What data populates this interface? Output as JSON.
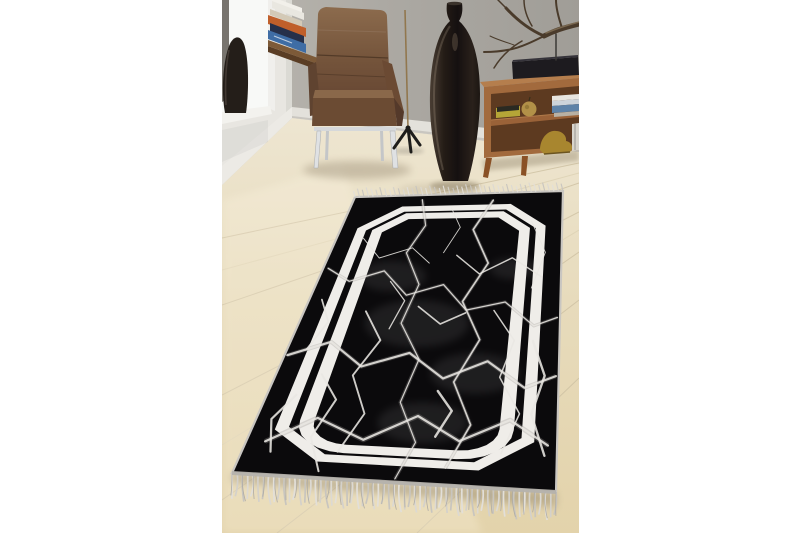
{
  "image": {
    "type": "product-photo",
    "subject": "Black and white marble-patterned fringed area rug styled in a living room with leather armchair, floor vase, branch decor and wooden sideboard",
    "background": "#ffffff"
  },
  "scene": {
    "objects": [
      {
        "id": "window",
        "label": "bright window opening with dark vase on the sill"
      },
      {
        "id": "book-stack",
        "label": "stack of books on a wall-mounted wooden shelf"
      },
      {
        "id": "armchair",
        "label": "brown leather armchair on chrome legs"
      },
      {
        "id": "floor-lamp",
        "label": "thin brass stand with black tripod base"
      },
      {
        "id": "floor-vase",
        "label": "tall dark bottle-shaped floor vase"
      },
      {
        "id": "branch",
        "label": "dry decorative branch on a stand"
      },
      {
        "id": "sideboard",
        "label": "mid-century wooden sideboard with ornaments and books"
      },
      {
        "id": "rug",
        "label": "black marble rug with double white frame border and fringe"
      }
    ]
  },
  "palette": {
    "wall_left": "#e8e6e1",
    "wall_back_near": "#a29f99",
    "wall_back_far": "#b8b5ae",
    "window": "#f8f9f7",
    "baseboard": "#eceae5",
    "floor": "#e6dab9",
    "leather": "#6e4e36",
    "wood_sideboard": "#a26a3d",
    "shelf_wood": "#7d5a38"
  },
  "rug": {
    "base_color": "#0b0a0c",
    "band_color": "#efede9",
    "vein_color": "#e9e7e3",
    "vein_ghost": "#9a9896",
    "binding_color": "#c9c6c1",
    "fringe_colors": [
      "#e2dfd9",
      "#d4d1cb",
      "#c8c5bf",
      "#dcd9d3"
    ],
    "design": "double white line frame with chamfered top corners and arched bottom corners over black marble crack field, fringed short ends",
    "frame": {
      "outer_band": {
        "a": 0.075,
        "b": 0.048,
        "c": 0.17,
        "cv": 0.09,
        "a2": 0.1175,
        "b2": 0.0707,
        "c2": 0.145,
        "cv2": 0.0773
      },
      "inner_band": {
        "a": 0.145,
        "b": 0.0773,
        "c": 0.129,
        "cv": 0.0687,
        "r": 0.175,
        "rv": 0.0933,
        "a2": 0.1925,
        "b2": 0.1027,
        "c2": 0.101,
        "cv2": 0.054,
        "r2": 0.1275,
        "rv2": 0.068
      }
    },
    "smudges": [
      [
        0.45,
        0.5,
        0.2
      ],
      [
        0.3,
        0.33,
        0.14
      ],
      [
        0.7,
        0.66,
        0.16
      ],
      [
        0.55,
        0.82,
        0.15
      ],
      [
        0.8,
        0.3,
        0.1
      ]
    ],
    "veins": [
      [
        [
          0.33,
          0.02
        ],
        [
          0.38,
          0.13
        ],
        [
          0.33,
          0.24
        ],
        [
          0.42,
          0.36
        ],
        [
          0.39,
          0.5
        ],
        [
          0.49,
          0.62
        ],
        [
          0.46,
          0.76
        ],
        [
          0.54,
          0.88
        ],
        [
          0.5,
          0.99
        ]
      ],
      [
        [
          0.67,
          0.03
        ],
        [
          0.6,
          0.15
        ],
        [
          0.69,
          0.28
        ],
        [
          0.61,
          0.42
        ],
        [
          0.7,
          0.55
        ],
        [
          0.63,
          0.69
        ],
        [
          0.71,
          0.82
        ],
        [
          0.65,
          0.95
        ]
      ],
      [
        [
          0.02,
          0.3
        ],
        [
          0.13,
          0.35
        ],
        [
          0.26,
          0.31
        ],
        [
          0.38,
          0.4
        ],
        [
          0.52,
          0.36
        ],
        [
          0.63,
          0.45
        ],
        [
          0.78,
          0.42
        ],
        [
          0.9,
          0.5
        ],
        [
          0.99,
          0.47
        ]
      ],
      [
        [
          0.01,
          0.62
        ],
        [
          0.15,
          0.57
        ],
        [
          0.29,
          0.65
        ],
        [
          0.45,
          0.6
        ],
        [
          0.59,
          0.68
        ],
        [
          0.74,
          0.62
        ],
        [
          0.88,
          0.7
        ],
        [
          0.99,
          0.66
        ]
      ],
      [
        [
          0.06,
          0.9
        ],
        [
          0.2,
          0.82
        ],
        [
          0.37,
          0.88
        ],
        [
          0.53,
          0.8
        ],
        [
          0.68,
          0.87
        ],
        [
          0.84,
          0.8
        ],
        [
          0.97,
          0.87
        ]
      ],
      [
        [
          0.12,
          0.18
        ],
        [
          0.22,
          0.26
        ],
        [
          0.35,
          0.22
        ],
        [
          0.44,
          0.28
        ]
      ],
      [
        [
          0.55,
          0.25
        ],
        [
          0.66,
          0.32
        ],
        [
          0.79,
          0.26
        ],
        [
          0.92,
          0.33
        ]
      ],
      [
        [
          0.24,
          0.46
        ],
        [
          0.33,
          0.56
        ],
        [
          0.27,
          0.68
        ],
        [
          0.35,
          0.8
        ],
        [
          0.3,
          0.92
        ]
      ],
      [
        [
          0.74,
          0.45
        ],
        [
          0.83,
          0.55
        ],
        [
          0.79,
          0.67
        ],
        [
          0.87,
          0.78
        ],
        [
          0.82,
          0.9
        ]
      ],
      [
        [
          0.44,
          0.44
        ],
        [
          0.54,
          0.5
        ],
        [
          0.63,
          0.46
        ]
      ],
      [
        [
          0.16,
          0.68
        ],
        [
          0.24,
          0.76
        ],
        [
          0.2,
          0.88
        ],
        [
          0.26,
          0.98
        ]
      ],
      [
        [
          0.86,
          0.12
        ],
        [
          0.93,
          0.24
        ],
        [
          0.88,
          0.37
        ]
      ],
      [
        [
          0.05,
          0.42
        ],
        [
          0.11,
          0.5
        ],
        [
          0.07,
          0.6
        ]
      ],
      [
        [
          0.48,
          0.06
        ],
        [
          0.54,
          0.14
        ],
        [
          0.49,
          0.24
        ]
      ],
      [
        [
          0.9,
          0.55
        ],
        [
          0.95,
          0.66
        ],
        [
          0.91,
          0.78
        ],
        [
          0.96,
          0.9
        ]
      ],
      [
        [
          0.1,
          0.75
        ],
        [
          0.05,
          0.83
        ],
        [
          0.09,
          0.93
        ]
      ],
      [
        [
          0.3,
          0.35
        ],
        [
          0.38,
          0.42
        ],
        [
          0.35,
          0.52
        ]
      ],
      [
        [
          0.58,
          0.72
        ],
        [
          0.64,
          0.78
        ],
        [
          0.6,
          0.86
        ]
      ]
    ]
  }
}
